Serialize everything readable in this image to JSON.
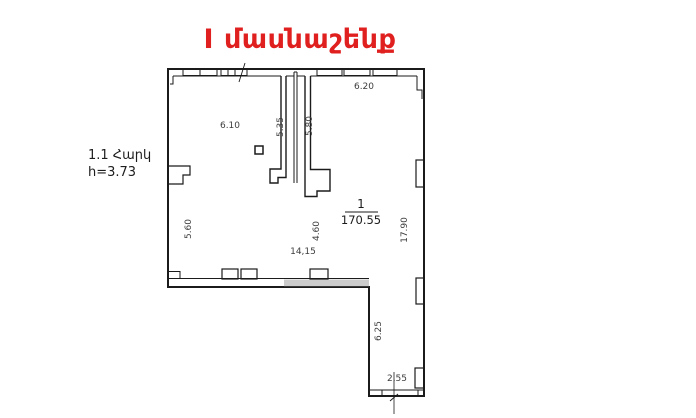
{
  "title": "I մասնաշենք",
  "floor_info": {
    "floor": "1.1 Հարկ",
    "height": "h=3.73"
  },
  "room": {
    "number": "1",
    "area": "170.55"
  },
  "dimensions": {
    "top_left_width": "6.10",
    "shaft_left_height": "5.35",
    "shaft_right_height": "5.80",
    "top_right_width": "6.20",
    "left_height": "5.60",
    "mid_height": "4.60",
    "bottom_width": "14,15",
    "right_height": "17.90",
    "corridor_height": "6.25",
    "corridor_bottom_width": "2,55"
  },
  "colors": {
    "title_red": "#e01f1f",
    "line_black": "#1b1b1b",
    "wall_gray": "#9a9a9a",
    "dim_text": "#3d3d3d"
  }
}
